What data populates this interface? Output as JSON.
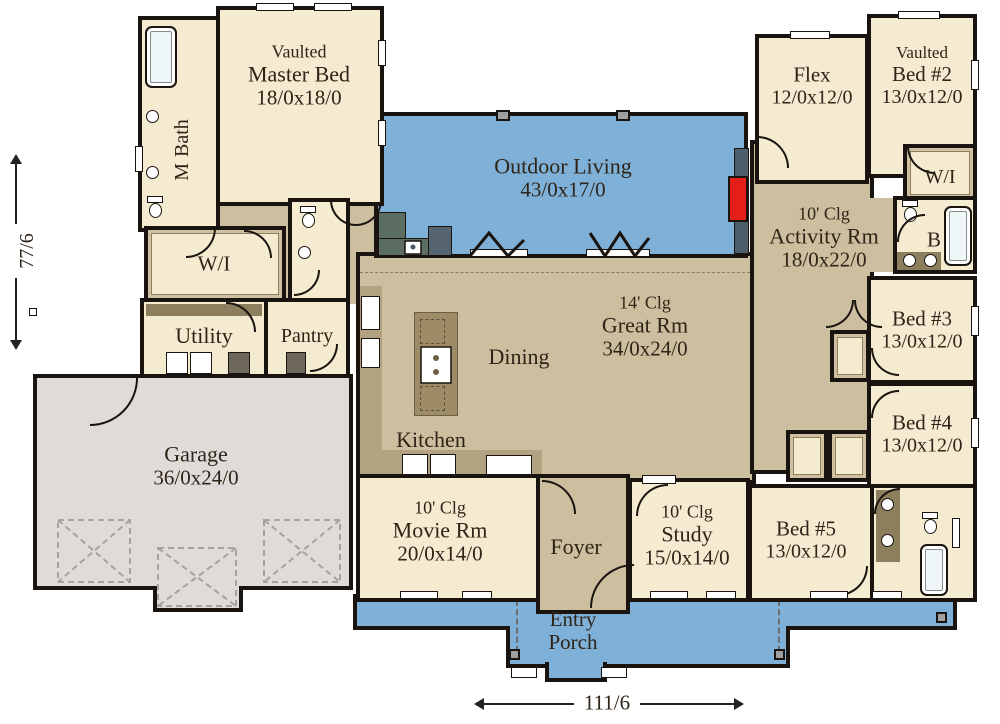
{
  "plan": {
    "dim_height": "77/6",
    "dim_width": "111/6",
    "rooms": {
      "master_bed": {
        "tag": "Vaulted",
        "name": "Master Bed",
        "size": "18/0x18/0"
      },
      "m_bath": {
        "line1": "M",
        "line2": "Bath"
      },
      "master_wi": {
        "name": "W/I"
      },
      "utility": {
        "name": "Utility"
      },
      "pantry": {
        "name": "Pantry"
      },
      "garage": {
        "name": "Garage",
        "size": "36/0x24/0"
      },
      "outdoor_living": {
        "name": "Outdoor Living",
        "size": "43/0x17/0"
      },
      "great_rm": {
        "ceiling": "14' Clg",
        "name": "Great Rm",
        "size": "34/0x24/0"
      },
      "dining": {
        "name": "Dining"
      },
      "kitchen": {
        "name": "Kitchen"
      },
      "flex": {
        "name": "Flex",
        "size": "12/0x12/0"
      },
      "bed2": {
        "tag": "Vaulted",
        "name": "Bed #2",
        "size": "13/0x12/0"
      },
      "bed2_wi": {
        "name": "W/I"
      },
      "bath_b": {
        "name": "B"
      },
      "activity": {
        "ceiling": "10' Clg",
        "name": "Activity Rm",
        "size": "18/0x22/0"
      },
      "bed3": {
        "name": "Bed #3",
        "size": "13/0x12/0"
      },
      "bed4": {
        "name": "Bed #4",
        "size": "13/0x12/0"
      },
      "bed5": {
        "name": "Bed #5",
        "size": "13/0x12/0"
      },
      "movie": {
        "ceiling": "10' Clg",
        "name": "Movie Rm",
        "size": "20/0x14/0"
      },
      "foyer": {
        "name": "Foyer"
      },
      "study": {
        "ceiling": "10' Clg",
        "name": "Study",
        "size": "15/0x14/0"
      },
      "entry_porch": {
        "line1": "Entry",
        "line2": "Porch"
      }
    },
    "colors": {
      "wall": "#19140f",
      "room_fill": "#f4ebd1",
      "open_fill": "#cdbe9f",
      "outdoor_blue": "#7fb0d8",
      "garage_gray": "#dedbd9",
      "fireplace_red": "#e31f18",
      "counter_tan": "#b3a281",
      "island_brown": "#9d8c66"
    },
    "icons": {
      "bathtub-icon": "rounded-rect shape",
      "toilet-icon": "tank+bowl shape",
      "sink-icon": "circle shape",
      "stove-icon": "white square with burner dots",
      "washer-icon": "dark square with X",
      "garage-door-icon": "dashed X box",
      "fireplace-icon": "red rectangle",
      "door-arc-icon": "quarter-circle arc",
      "folding-door-icon": "zigzag polyline",
      "dimension-arrow-icon": "double-headed arrow"
    }
  }
}
